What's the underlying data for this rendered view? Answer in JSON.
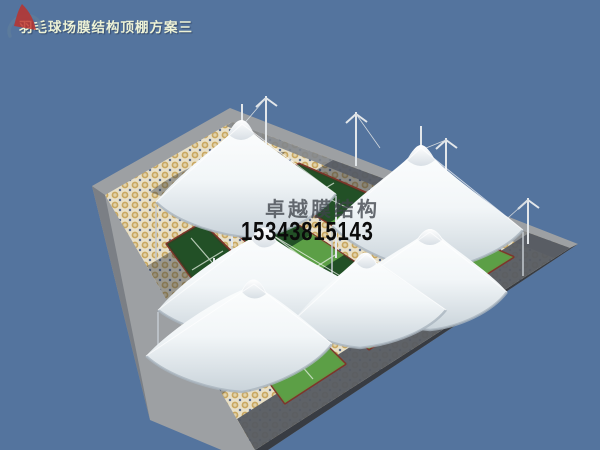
{
  "title": "羽毛球场膜结构顶棚方案三",
  "watermark": {
    "company": "卓越膜结构",
    "phone": "15343815143",
    "logo_icon": "red-sail-swoosh-logo"
  },
  "scene": {
    "type": "3d-architectural-render",
    "subject": "badminton-court-membrane-canopy",
    "view": "aerial-isometric",
    "canopy_count": 6,
    "court_count": 3,
    "colors": {
      "sky": "#54749E",
      "membrane": "#F7FAFC",
      "membrane_shade": "#C9D3DA",
      "court_green": "#3F7D36",
      "court_green_shadow": "#1D4823",
      "court_green_lit": "#5FA348",
      "court_edging": "#7E352A",
      "court_line": "#E5EFE2",
      "mosaic_tan": "#C9A75F",
      "mosaic_cream": "#E8E0C8",
      "mosaic_blue": "#5E6E91",
      "platform_gray": "#9DA0A3",
      "platform_dark": "#383C43",
      "title_text": "#EDF2D6",
      "phone_text": "#0B0B0B",
      "company_text": "#3F444B",
      "logo_red": "#C03028",
      "logo_blue": "#5E7C9C"
    }
  }
}
